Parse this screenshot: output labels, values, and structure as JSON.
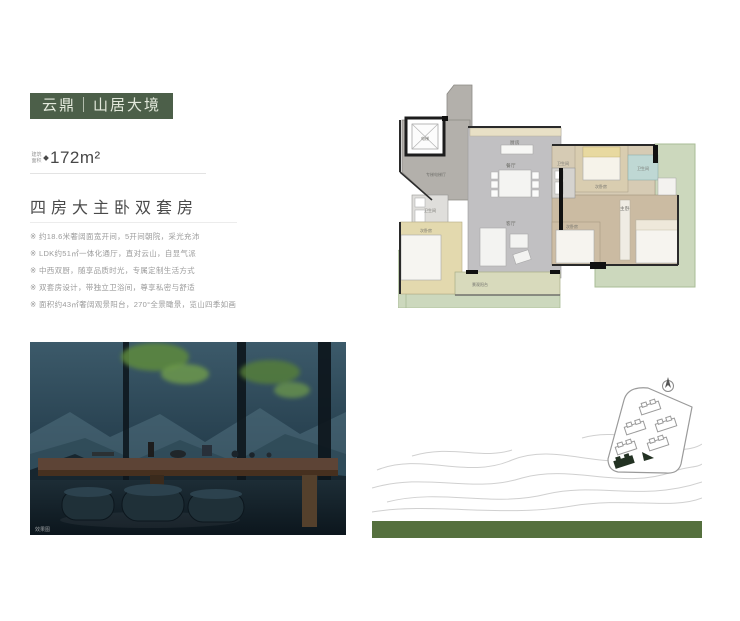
{
  "colors": {
    "badge_bg": "#4c5f49",
    "badge_text": "#e3e9dc",
    "bar_green": "#55703e",
    "plan_green": "#ccd8bd",
    "plan_gray": "#c1c0c2",
    "plan_wood": "#cbbba2"
  },
  "header": {
    "badge": "云鼎｜山居大境"
  },
  "listing": {
    "area_label": "建筑面积",
    "area_value": "172m²",
    "headline": "四房大主卧双套房",
    "features": [
      "※ 约18.6米奢阔面宽开间，5开间朝院，采光充沛",
      "※ LDK约51㎡一体化通厅，直对云山，自显气派",
      "※ 中西双厨，随享品质时光，专属定制生活方式",
      "※ 双套房设计，带独立卫浴间，尊享私密与舒适",
      "※ 面积约43㎡奢阔观景阳台，270°全景瞰景，览山四季如画"
    ]
  },
  "floorplan": {
    "labels": [
      "电梯",
      "专梯电梯厅",
      "厨房",
      "餐厅",
      "客厅",
      "卫生间",
      "次卧房",
      "卫生间",
      "次卧房",
      "卫生间",
      "主卧",
      "次卧房",
      "景观阳台"
    ]
  },
  "photo": {
    "watermark": "效果图"
  }
}
